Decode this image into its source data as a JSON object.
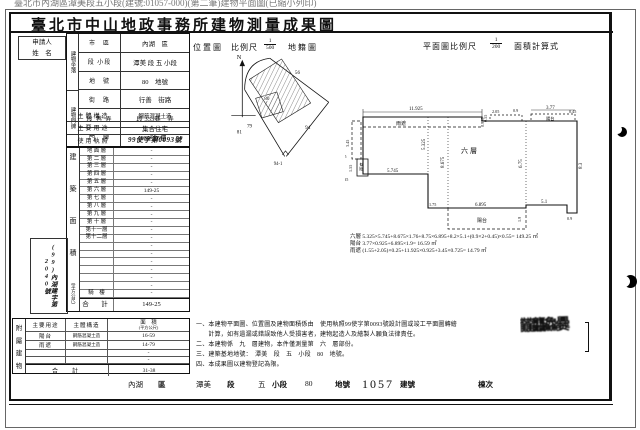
{
  "meta": {
    "top_line": "臺北市內湖區潭美段五小段(建號:01057-000)(第二筆)建物平面圖(已縮小列印)",
    "title": "臺北市中山地政事務所建物測量成果圖"
  },
  "applicant": {
    "line1": "申請人",
    "line2": "姓　名"
  },
  "upper_table": {
    "group1_label": "建物坐落",
    "group2_label": "建物門牌",
    "rows": [
      {
        "label": "市　區",
        "value": "內湖　區"
      },
      {
        "label": "段 小段",
        "value": "潭美 段 五 小段"
      },
      {
        "label": "地　號",
        "value": "80　地號"
      },
      {
        "label": "街　路",
        "value": "行善　街路"
      },
      {
        "label": "段 巷 弄",
        "value": "段 333巷　弄"
      },
      {
        "label": "門　牌",
        "value": "80號6樓"
      }
    ]
  },
  "attr_rows": [
    {
      "label": "主體構造",
      "value": "鋼筋混凝土造"
    },
    {
      "label": "主要用途",
      "value": "集合住宅"
    },
    {
      "label": "使用執照",
      "value": "99使字第0093號"
    }
  ],
  "area_table": {
    "header_chars": [
      "建",
      "築",
      "面",
      "積"
    ],
    "unit": "（平方公尺）",
    "rows": [
      {
        "label": "地 面 層",
        "value": "-"
      },
      {
        "label": "第 二 層",
        "value": "-"
      },
      {
        "label": "第 三 層",
        "value": "-"
      },
      {
        "label": "第 四 層",
        "value": "-"
      },
      {
        "label": "第 五 層",
        "value": "-"
      },
      {
        "label": "第 六 層",
        "value": "149-25"
      },
      {
        "label": "第 七 層",
        "value": "-"
      },
      {
        "label": "第 八 層",
        "value": "-"
      },
      {
        "label": "第 九 層",
        "value": "-"
      },
      {
        "label": "第 十 層",
        "value": "-"
      },
      {
        "label": "第十一層",
        "value": "-"
      },
      {
        "label": "第十二層",
        "value": "-"
      },
      {
        "label": "",
        "value": "-"
      },
      {
        "label": "",
        "value": "-"
      },
      {
        "label": "",
        "value": "-"
      },
      {
        "label": "",
        "value": "-"
      },
      {
        "label": "",
        "value": "-"
      },
      {
        "label": "",
        "value": "-"
      },
      {
        "label": "騎　樓",
        "value": "-"
      }
    ],
    "total_label": "合　計",
    "total_value": "149-25"
  },
  "side_stamp": "(99)內湖建字第2040號",
  "annex_table": {
    "title_chars": [
      "附",
      "屬",
      "建",
      "物"
    ],
    "col_use": "主要用途",
    "col_structure": "主體構造",
    "col_area": "面　積",
    "col_area_unit": "(平方公尺)",
    "rows": [
      {
        "use": "陽台",
        "structure": "鋼筋混凝土造",
        "area": "16-59"
      },
      {
        "use": "雨遮",
        "structure": "鋼筋混凝土造",
        "area": "14-79"
      },
      {
        "use": "",
        "structure": "",
        "area": "-"
      },
      {
        "use": "",
        "structure": "",
        "area": "-"
      }
    ],
    "total_label": "合　計",
    "total_value": "31-38"
  },
  "site_map": {
    "title": "位置圖",
    "scale_label": "比例尺",
    "scale_num": "1",
    "scale_den": "500",
    "cadastre": "地籍圖",
    "north": "N",
    "parcels": {
      "p56": "56",
      "p79": "79",
      "p80": "80",
      "p81": "81",
      "p94": "94",
      "p941": "94-1"
    }
  },
  "floor_plan": {
    "scale_label": "平面圖比例尺",
    "scale_num": "1",
    "scale_den": "200",
    "calc_label": "面積計算式",
    "room": "六層",
    "balcony": "陽台",
    "canopy": "雨遮",
    "dims": {
      "top": "11.925",
      "left_v": "3.45",
      "left_w": "0.725",
      "box_h": "1.55",
      "box_w": "0.35",
      "bottom_left": "5.745",
      "room_left_v": "5.325",
      "mid_v": "8.675",
      "step": "1.75",
      "bottom_mid": "6.895",
      "balcony_h": "1.9",
      "canopy_a": "2.05",
      "canopy_b": "0.9",
      "balcony_top": "3.77",
      "balcony_end": "0.45",
      "right_mid_v": "6.75",
      "right_v": "8.3",
      "bottom_right": "5.1",
      "corner": "0.9",
      "offset": "0.55",
      "canopy_d": "0.925"
    },
    "formulas": [
      "六層 5.325×5.745+8.675×1.76+8.75×6.895+8.2×5.1+(0.9×2+0.45)×0.55= 149.25 ㎡",
      "陽台 3.77×0.925+6.895×1.9= 16.59 ㎡",
      "雨遮 (1.55+2.05)×0.25+11.925×0.925+3.45×0.725= 14.79 ㎡"
    ]
  },
  "notes": [
    "一、本建物平面圖、位置圖及建物面積係由　使用執照99使字第0093號設計圖或竣工平面圖轉繪",
    "　　計算，如有遺漏或錯誤致他人受損害者，建物起造人及繪製人願負法律責任。",
    "二、本建物係　九　層建物，本件僅測量第　六　層部份。",
    "三、建築基地地號：　潭美　段　五　小段　80　地號。",
    "四、本成果圖以建物登記為限。"
  ],
  "stamp_text": "龖龘鱻爨",
  "bottom_strip": {
    "district": "內湖",
    "district_u": "區",
    "section": "潭美",
    "section_u": "段",
    "subsection": "五",
    "subsection_u": "小段",
    "parcel": "80",
    "parcel_u": "地號",
    "building_no": "1057",
    "building_u": "建號",
    "block_u": "棟次"
  }
}
